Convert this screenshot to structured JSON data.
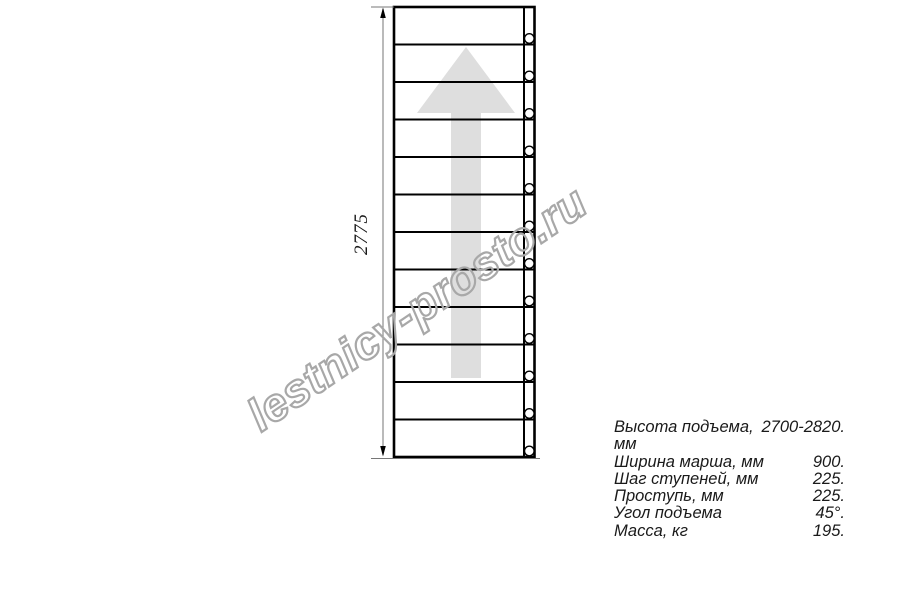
{
  "watermark": {
    "text": "lestnicy-prosto.ru"
  },
  "diagram": {
    "type": "stair-flight-plan-view",
    "dimension_label": "2775",
    "steps_count": 12,
    "arrow_direction": "up",
    "colors": {
      "line": "#000000",
      "dimension_line": "#8c8c8c",
      "extension_line": "#777777",
      "arrow_fill": "#dedede",
      "hole_fill": "#ffffff",
      "text": "#1a1a1a",
      "watermark_outline": "#a8a8a8"
    }
  },
  "specs": {
    "rows": [
      {
        "label": "Высота подъема, мм",
        "value": "2700-2820."
      },
      {
        "label": "Ширина марша, мм",
        "value": "900."
      },
      {
        "label": "Шаг ступеней, мм",
        "value": "225."
      },
      {
        "label": "Проступь, мм",
        "value": "225."
      },
      {
        "label": "Угол подъема",
        "value": "45°."
      },
      {
        "label": "Масса, кг",
        "value": "195."
      }
    ]
  }
}
